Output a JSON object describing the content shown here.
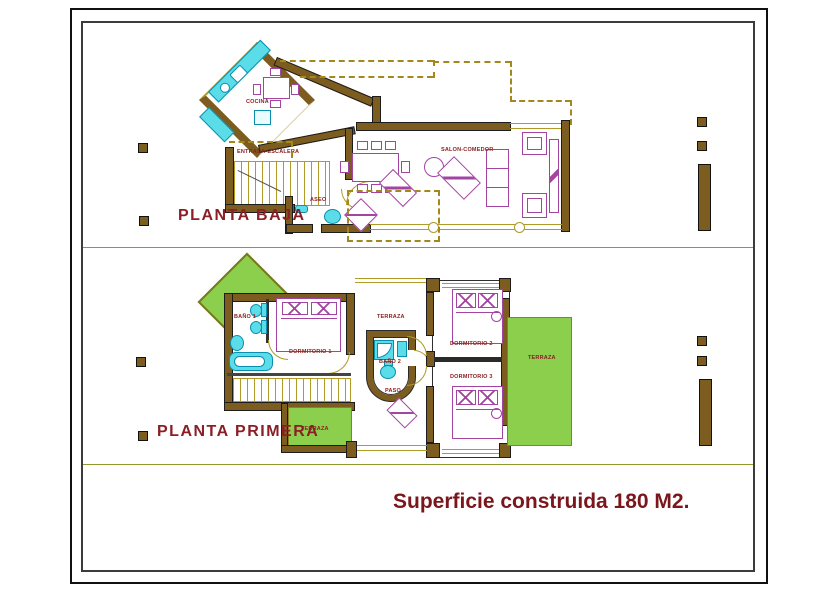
{
  "drawing_type": "house floor plans",
  "ground_floor": {
    "title": "PLANTA BAJA",
    "labels": {
      "cocina": "COCINA",
      "entrada": "ENTRADA-ESCALERA",
      "aseo": "ASEO",
      "salon": "SALON-COMEDOR"
    }
  },
  "first_floor": {
    "title": "PLANTA PRIMERA",
    "labels": {
      "bano1": "BAÑO 1",
      "dormitorio1": "DORMITORIO 1",
      "terraza_top": "TERRAZA",
      "bano2": "BAÑO 2",
      "paso": "PASO",
      "dormitorio2": "DORMITORIO 2",
      "dormitorio3": "DORMITORIO 3",
      "terraza_right": "TERRAZA",
      "terraza_bottom": "TERRAZA"
    }
  },
  "footer": {
    "area_text": "Superficie construida 180 M2."
  },
  "colors": {
    "wall_brown": "#7d5c20",
    "line_olive": "#b09a28",
    "roof_dash_olive": "#a3881c",
    "terrace_green": "#8ccf4d",
    "fixture_cyan": "#5adce9",
    "fixture_cyan_stroke": "#0a8fae",
    "furniture_magenta": "#a344a3",
    "room_label_red": "#8b2020",
    "title_red": "#8b1f26",
    "footer_red": "#7a161c",
    "section_divider_olive": "#8f9a2e"
  }
}
